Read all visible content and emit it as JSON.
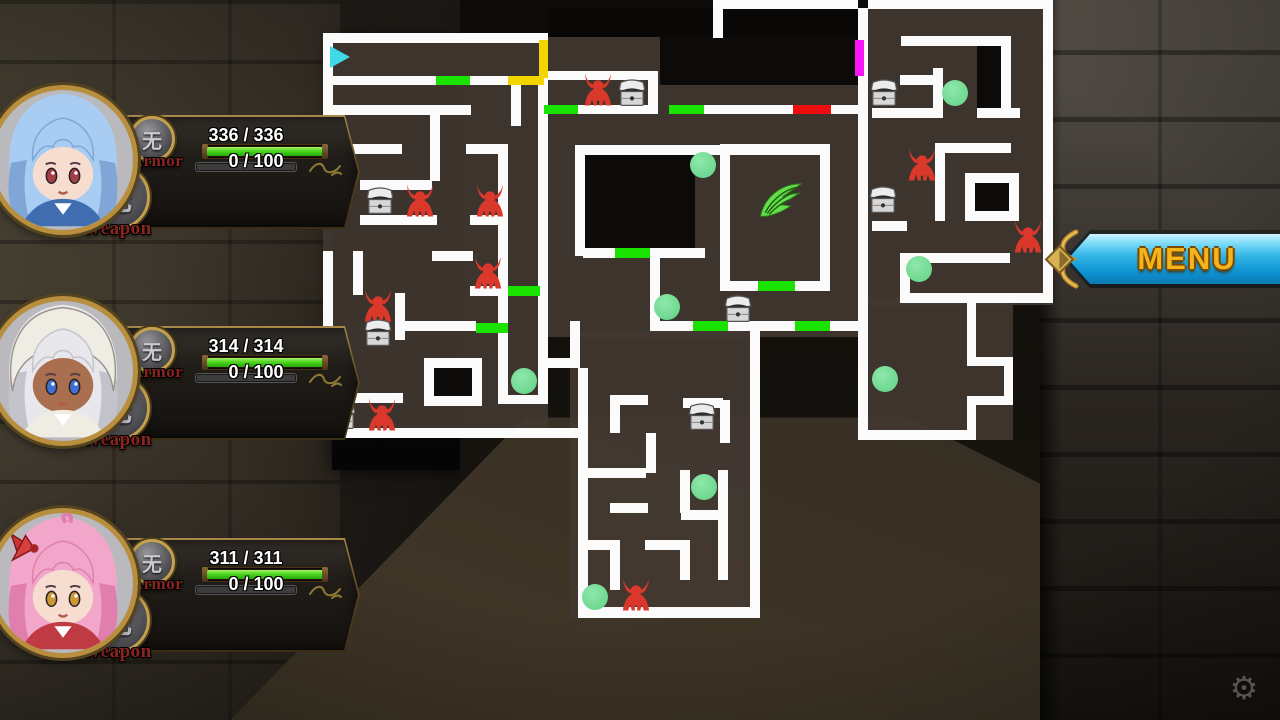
{
  "menu": {
    "label": "MENU"
  },
  "gear_icon": "⚙",
  "colors": {
    "wall": "#fbfbfb",
    "hp_green": "#4ed61e",
    "player_cyan": "#3fd9e8",
    "enemy_red": "#d9382b",
    "dot_green": "#6ed890",
    "wing_green": "#63df4a",
    "menu_gold": "#f6b41c",
    "menu_cyan": "#2fb4e6",
    "door_green": "#1be300",
    "door_yellow": "#f2d500",
    "door_red": "#ed0f0f",
    "door_magenta": "#f714f7"
  },
  "party": [
    {
      "top": 85,
      "hp": "336 / 336",
      "hp_pct": 100,
      "tp": "0 / 100",
      "tp_pct": 0,
      "armor_label": "Armor",
      "weapon_label": "Weapon",
      "medallion_glyph": "无",
      "style": "blue",
      "hair": "#a9cdf2",
      "hair_dark": "#7fa6d6",
      "skin": "#f6ddcf",
      "eye": "#a33f46",
      "outfit": "#3f6db0"
    },
    {
      "top": 296,
      "hp": "314 / 314",
      "hp_pct": 100,
      "tp": "0 / 100",
      "tp_pct": 0,
      "armor_label": "Armor",
      "weapon_label": "Weapon",
      "medallion_glyph": "无",
      "style": "hood",
      "hair": "#e8e8ec",
      "hair_dark": "#c3c3cc",
      "skin": "#aa6f4e",
      "eye": "#3f6fd0",
      "outfit": "#efece4"
    },
    {
      "top": 508,
      "hp": "311 / 311",
      "hp_pct": 100,
      "tp": "0 / 100",
      "tp_pct": 0,
      "armor_label": "Armor",
      "weapon_label": "Weapon",
      "medallion_glyph": "无",
      "style": "bow",
      "hair": "#f2a6c9",
      "hair_dark": "#e07fae",
      "skin": "#f6ddcf",
      "eye": "#c79a35",
      "outfit": "#bf3a43"
    }
  ],
  "map": {
    "player": {
      "x": 330,
      "y": 46,
      "dir": "right"
    },
    "wing": {
      "x": 781,
      "y": 201
    },
    "floors": [
      [
        323,
        33,
        225,
        405
      ],
      [
        548,
        37,
        312,
        300
      ],
      [
        570,
        331,
        190,
        287
      ],
      [
        868,
        8,
        185,
        297
      ],
      [
        858,
        297,
        155,
        143
      ]
    ],
    "voids": [
      [
        548,
        8,
        112,
        29
      ],
      [
        660,
        8,
        198,
        77
      ],
      [
        583,
        155,
        112,
        93
      ],
      [
        977,
        46,
        33,
        62
      ],
      [
        975,
        183,
        34,
        28
      ],
      [
        434,
        368,
        38,
        28
      ]
    ],
    "walls": [
      [
        323,
        33,
        225,
        10
      ],
      [
        323,
        33,
        10,
        195
      ],
      [
        323,
        76,
        113,
        9
      ],
      [
        470,
        76,
        38,
        9
      ],
      [
        326,
        105,
        145,
        10
      ],
      [
        430,
        115,
        10,
        66
      ],
      [
        511,
        78,
        10,
        48
      ],
      [
        340,
        144,
        62,
        10
      ],
      [
        466,
        144,
        42,
        10
      ],
      [
        498,
        144,
        10,
        260
      ],
      [
        538,
        78,
        10,
        326
      ],
      [
        360,
        180,
        72,
        10
      ],
      [
        360,
        215,
        77,
        10
      ],
      [
        470,
        215,
        38,
        10
      ],
      [
        432,
        251,
        41,
        10
      ],
      [
        470,
        286,
        38,
        10
      ],
      [
        323,
        251,
        10,
        184
      ],
      [
        353,
        251,
        10,
        44
      ],
      [
        395,
        293,
        10,
        47
      ],
      [
        396,
        321,
        80,
        10
      ],
      [
        424,
        358,
        58,
        10
      ],
      [
        424,
        358,
        10,
        48
      ],
      [
        472,
        358,
        10,
        48
      ],
      [
        424,
        396,
        58,
        10
      ],
      [
        323,
        393,
        80,
        10
      ],
      [
        323,
        428,
        262,
        10
      ],
      [
        498,
        395,
        50,
        9
      ],
      [
        542,
        71,
        112,
        9
      ],
      [
        648,
        71,
        10,
        43
      ],
      [
        578,
        105,
        70,
        9
      ],
      [
        704,
        105,
        89,
        9
      ],
      [
        831,
        105,
        27,
        9
      ],
      [
        575,
        145,
        255,
        10
      ],
      [
        575,
        145,
        10,
        111
      ],
      [
        583,
        248,
        32,
        10
      ],
      [
        650,
        248,
        55,
        10
      ],
      [
        650,
        248,
        10,
        83
      ],
      [
        720,
        144,
        110,
        10
      ],
      [
        720,
        144,
        10,
        147
      ],
      [
        820,
        144,
        10,
        147
      ],
      [
        720,
        281,
        38,
        10
      ],
      [
        795,
        281,
        35,
        10
      ],
      [
        656,
        321,
        37,
        10
      ],
      [
        728,
        321,
        67,
        10
      ],
      [
        830,
        321,
        28,
        10
      ],
      [
        858,
        8,
        10,
        432
      ],
      [
        713,
        0,
        145,
        9
      ],
      [
        713,
        0,
        10,
        38
      ],
      [
        570,
        321,
        10,
        47
      ],
      [
        540,
        358,
        40,
        10
      ],
      [
        578,
        368,
        10,
        250
      ],
      [
        610,
        395,
        38,
        10
      ],
      [
        610,
        395,
        10,
        38
      ],
      [
        683,
        398,
        40,
        10
      ],
      [
        720,
        400,
        10,
        43
      ],
      [
        646,
        433,
        10,
        40
      ],
      [
        578,
        468,
        68,
        10
      ],
      [
        610,
        503,
        38,
        10
      ],
      [
        680,
        470,
        10,
        43
      ],
      [
        681,
        510,
        42,
        10
      ],
      [
        718,
        470,
        10,
        110
      ],
      [
        645,
        540,
        38,
        10
      ],
      [
        680,
        540,
        10,
        40
      ],
      [
        578,
        540,
        42,
        10
      ],
      [
        610,
        550,
        10,
        40
      ],
      [
        578,
        607,
        182,
        11
      ],
      [
        750,
        331,
        10,
        287
      ],
      [
        868,
        0,
        178,
        9
      ],
      [
        1043,
        0,
        10,
        303
      ],
      [
        901,
        36,
        110,
        10
      ],
      [
        1001,
        36,
        10,
        82
      ],
      [
        933,
        68,
        10,
        40
      ],
      [
        900,
        75,
        37,
        10
      ],
      [
        872,
        108,
        71,
        10
      ],
      [
        977,
        108,
        43,
        10
      ],
      [
        935,
        143,
        76,
        10
      ],
      [
        935,
        143,
        10,
        78
      ],
      [
        965,
        173,
        54,
        10
      ],
      [
        965,
        211,
        54,
        10
      ],
      [
        965,
        173,
        10,
        48
      ],
      [
        1009,
        173,
        10,
        48
      ],
      [
        872,
        221,
        35,
        10
      ],
      [
        900,
        253,
        110,
        10
      ],
      [
        900,
        253,
        10,
        42
      ],
      [
        900,
        293,
        143,
        10
      ],
      [
        858,
        430,
        117,
        10
      ],
      [
        967,
        300,
        9,
        60
      ],
      [
        967,
        357,
        46,
        9
      ],
      [
        1004,
        357,
        9,
        48
      ],
      [
        967,
        396,
        46,
        9
      ],
      [
        967,
        402,
        9,
        38
      ]
    ],
    "doors": [
      [
        436,
        76,
        34,
        9,
        "green"
      ],
      [
        508,
        76,
        36,
        9,
        "yellow"
      ],
      [
        539,
        40,
        9,
        38,
        "yellow"
      ],
      [
        544,
        105,
        34,
        9,
        "green"
      ],
      [
        669,
        105,
        35,
        9,
        "green"
      ],
      [
        793,
        105,
        38,
        9,
        "red"
      ],
      [
        855,
        40,
        9,
        36,
        "magenta"
      ],
      [
        615,
        248,
        35,
        10,
        "green"
      ],
      [
        758,
        281,
        37,
        10,
        "green"
      ],
      [
        693,
        321,
        35,
        10,
        "green"
      ],
      [
        795,
        321,
        35,
        10,
        "green"
      ],
      [
        508,
        286,
        32,
        10,
        "green"
      ],
      [
        476,
        323,
        32,
        10,
        "green"
      ]
    ],
    "enemies": [
      [
        598,
        90
      ],
      [
        420,
        201
      ],
      [
        490,
        201
      ],
      [
        488,
        273
      ],
      [
        378,
        306
      ],
      [
        382,
        415
      ],
      [
        922,
        165
      ],
      [
        1028,
        237
      ],
      [
        636,
        595
      ]
    ],
    "chests": [
      [
        632,
        92
      ],
      [
        380,
        200
      ],
      [
        378,
        332
      ],
      [
        342,
        415
      ],
      [
        884,
        92
      ],
      [
        883,
        199
      ],
      [
        738,
        308
      ],
      [
        702,
        416
      ]
    ],
    "dots": [
      [
        703,
        165
      ],
      [
        667,
        307
      ],
      [
        524,
        381
      ],
      [
        704,
        487
      ],
      [
        595,
        597
      ],
      [
        955,
        93
      ],
      [
        919,
        269
      ],
      [
        885,
        379
      ]
    ]
  }
}
